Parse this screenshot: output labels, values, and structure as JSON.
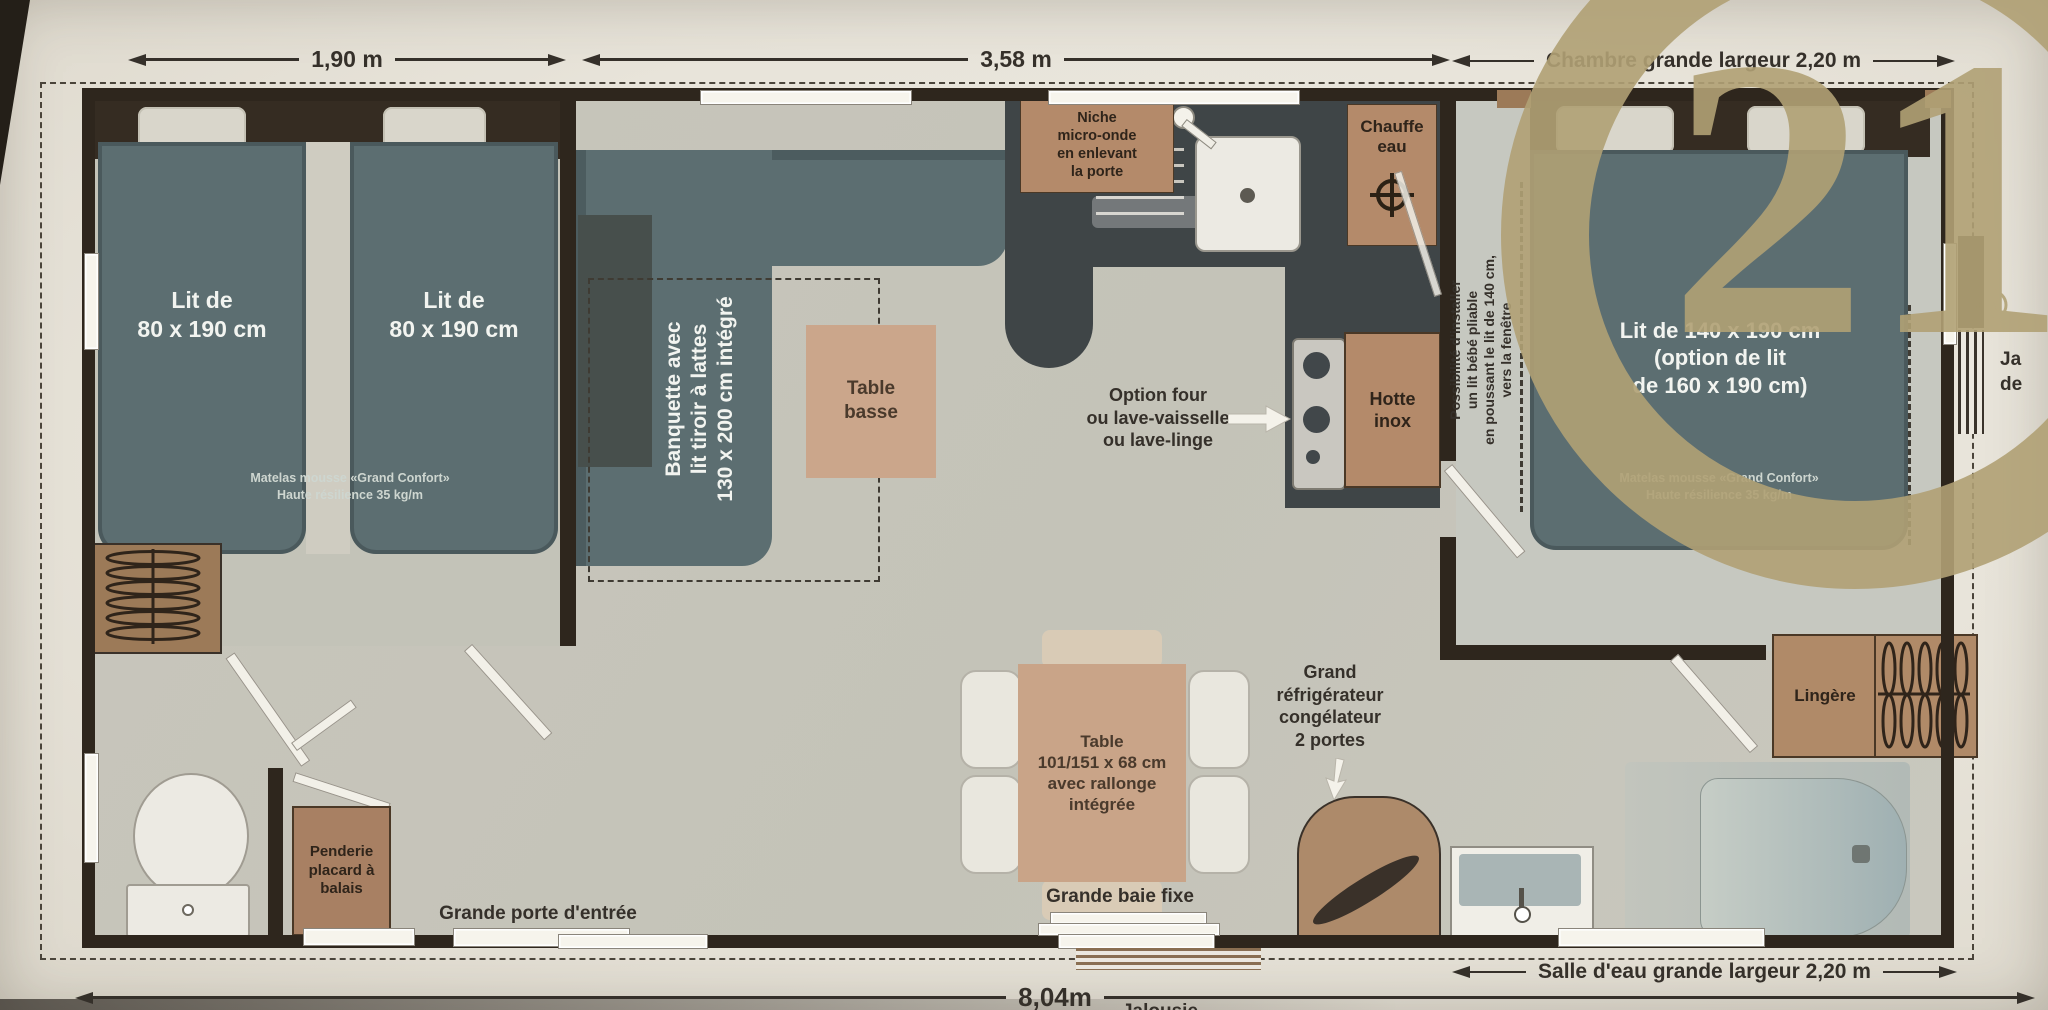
{
  "dimensions": {
    "room1_width": "1,90 m",
    "living_width": "3,58 m",
    "bedroom2_width": "Chambre grande largeur 2,20 m",
    "total_length": "8,04m",
    "bathroom_width": "Salle d'eau grande largeur 2,20 m",
    "bottom_cutoff_label": "Jalousie"
  },
  "bedroom_left": {
    "bed1_label": "Lit de\n80 x 190 cm",
    "bed2_label": "Lit de\n80 x 190 cm",
    "mattress_note": "Matelas mousse «Grand Confort»\nHaute résilience 35 kg/m"
  },
  "entry": {
    "closet_label": "Penderie\nplacard à\nbalais",
    "entrance_label": "Grande porte d'entrée"
  },
  "living": {
    "banquette_label": "Banquette avec\nlit tiroir à lattes\n130 x 200 cm intégré",
    "coffee_table_label": "Table\nbasse",
    "dining_table_label": "Table\n101/151 x 68 cm\navec rallonge\nintégrée",
    "bay_window_label": "Grande baie fixe"
  },
  "kitchen": {
    "microwave_label": "Niche\nmicro-onde\nen enlevant\nla porte",
    "water_heater_label": "Chauffe\neau",
    "hood_label": "Hotte\ninox",
    "appliance_option_label": "Option four\nou lave-vaisselle\nou lave-linge",
    "fridge_label": "Grand\nréfrigérateur\ncongélateur\n2 portes"
  },
  "bedroom_right": {
    "bed_label": "Lit de 140 x 190 cm\n(option de lit\nde 160 x 190 cm)",
    "mattress_note": "Matelas mousse «Grand Confort»\nHaute résilience 35 kg/m",
    "baby_bed_note": "Possibilité d'installer\nun lit bébé pliable\nen poussant le lit de 140 cm,\nvers la fenêtre"
  },
  "bathroom": {
    "linen_label": "Lingère"
  },
  "logo": {
    "number": "21",
    "registered": "R",
    "gold": "#b1a175"
  },
  "edge_text": {
    "partial": "Ja\nde"
  }
}
